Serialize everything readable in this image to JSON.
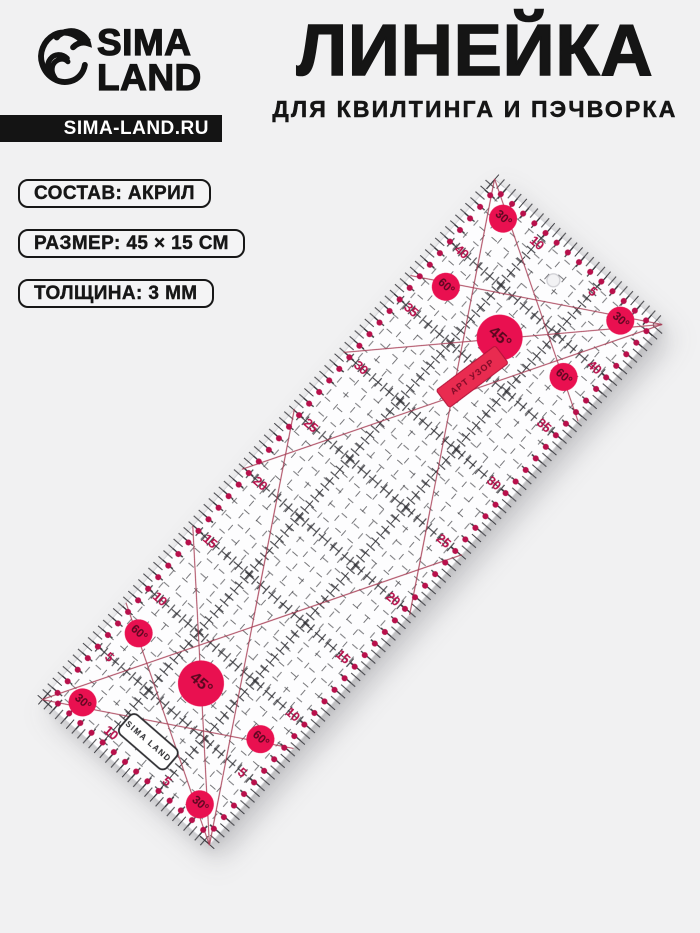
{
  "page": {
    "background": "#f1f1f2"
  },
  "header": {
    "logo_line1": "SIMA",
    "logo_line2": "LAND",
    "site_url": "SIMA-LAND.RU",
    "title": "ЛИНЕЙКА",
    "subtitle": "ДЛЯ КВИЛТИНГА И ПЭЧВОРКА"
  },
  "specs": [
    {
      "label": "СОСТАВ: АКРИЛ"
    },
    {
      "label": "РАЗМЕР: 45 × 15 СМ"
    },
    {
      "label": "ТОЛЩИНА: 3 ММ"
    }
  ],
  "ruler": {
    "length_cm": 45,
    "height_cm": 15,
    "long_edge_numbers": [
      5,
      10,
      15,
      20,
      25,
      30,
      35,
      40
    ],
    "short_edge_numbers": [
      5,
      10
    ],
    "dot_every_cm": 1,
    "brand_label": "SIMA LAND",
    "sticker_label": "АРТ УЗОР",
    "angle_markers": [
      {
        "label": "30°",
        "x_cm": 1.6,
        "y_cm": 2.2,
        "size": "small"
      },
      {
        "label": "60°",
        "x_cm": 7.4,
        "y_cm": 2.0,
        "size": "small"
      },
      {
        "label": "45°",
        "x_cm": 7.6,
        "y_cm": 7.4,
        "size": "large"
      },
      {
        "label": "30°",
        "x_cm": 1.6,
        "y_cm": 12.7,
        "size": "small"
      },
      {
        "label": "60°",
        "x_cm": 7.4,
        "y_cm": 12.9,
        "size": "small"
      },
      {
        "label": "60°",
        "x_cm": 37.6,
        "y_cm": 2.3,
        "size": "small"
      },
      {
        "label": "30°",
        "x_cm": 43.4,
        "y_cm": 2.2,
        "size": "small"
      },
      {
        "label": "45°",
        "x_cm": 37.4,
        "y_cm": 7.3,
        "size": "large"
      },
      {
        "label": "60°",
        "x_cm": 38.2,
        "y_cm": 12.3,
        "size": "small"
      },
      {
        "label": "30°",
        "x_cm": 43.4,
        "y_cm": 12.7,
        "size": "small"
      }
    ],
    "diagonal_lines_cm": [
      [
        [
          0,
          15
        ],
        [
          8.36,
          0
        ]
      ],
      [
        [
          0,
          15
        ],
        [
          15,
          0
        ]
      ],
      [
        [
          0,
          15
        ],
        [
          25.1,
          0
        ]
      ],
      [
        [
          45,
          15
        ],
        [
          36.64,
          0
        ]
      ],
      [
        [
          45,
          15
        ],
        [
          30,
          0
        ]
      ],
      [
        [
          45,
          15
        ],
        [
          19.9,
          0
        ]
      ],
      [
        [
          0,
          0
        ],
        [
          8.36,
          15
        ]
      ],
      [
        [
          0,
          0
        ],
        [
          25.1,
          15
        ]
      ],
      [
        [
          45,
          0
        ],
        [
          36.64,
          15
        ]
      ],
      [
        [
          45,
          0
        ],
        [
          19.9,
          15
        ]
      ]
    ],
    "colors": {
      "marking_red": "#b8104b",
      "circle_red": "#e91050",
      "circle_text": "#59071f",
      "line_red": "#a63a52",
      "grid_black": "#3d3d42",
      "major_black": "#2e2e33",
      "sticker_red": "#e92b50",
      "ruler_face": "#fdfdfe"
    }
  }
}
